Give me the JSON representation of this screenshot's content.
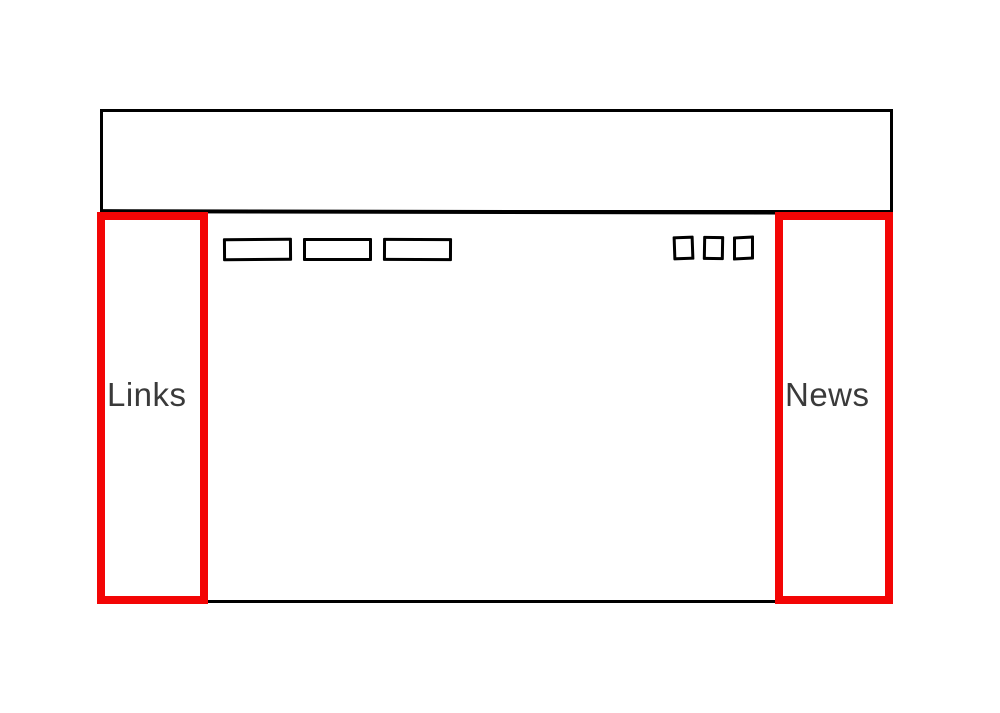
{
  "colors": {
    "outline": "#000000",
    "highlight": "#f30505",
    "label": "#3a3a3a",
    "background": "#ffffff"
  },
  "left_sidebar": {
    "label": "Links"
  },
  "right_sidebar": {
    "label": "News"
  },
  "nav_buttons": [
    {
      "label": ""
    },
    {
      "label": ""
    },
    {
      "label": ""
    }
  ],
  "window_controls": [
    {
      "label": ""
    },
    {
      "label": ""
    },
    {
      "label": ""
    }
  ]
}
